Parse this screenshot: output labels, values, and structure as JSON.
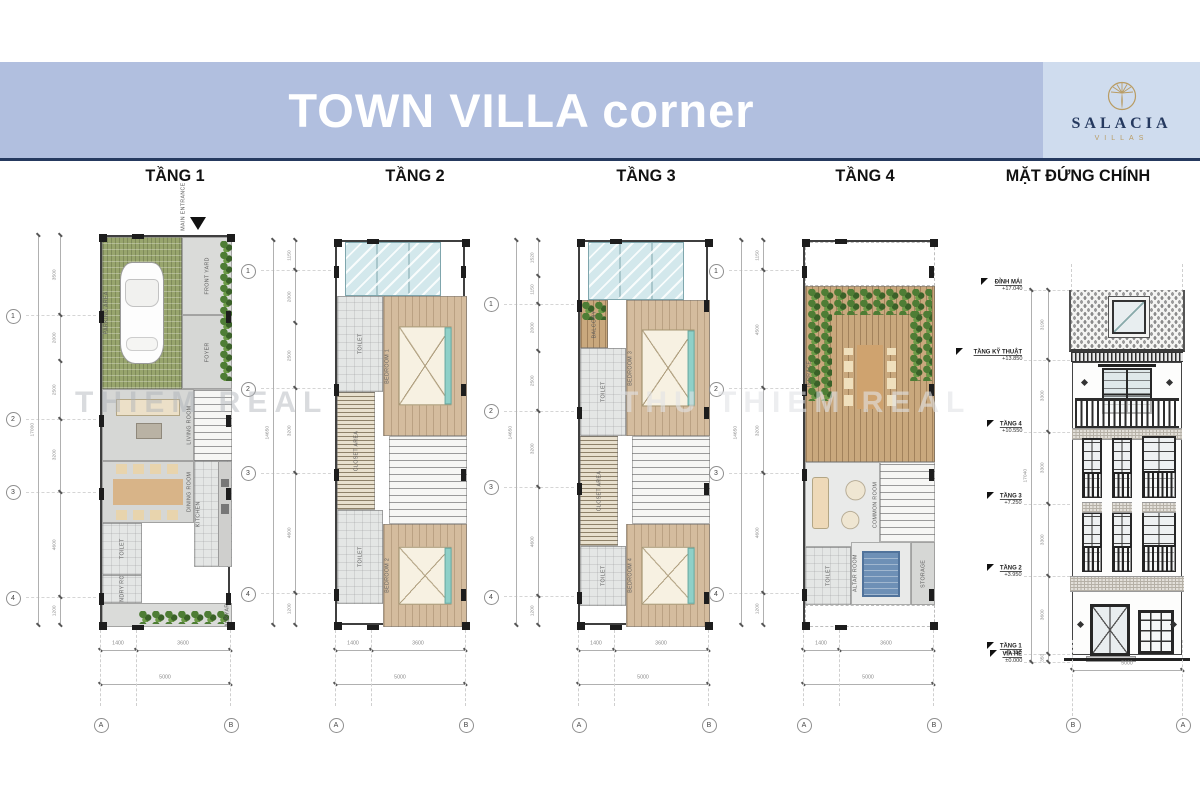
{
  "banner": {
    "title": "TOWN VILLA corner",
    "bg": "#b1bfdf",
    "logo_bg": "#cfdcee",
    "rule_color": "#25395f"
  },
  "logo": {
    "brand": "SALACIA",
    "subtitle": "VILLAS",
    "gold": "#b99c63",
    "navy": "#25395f"
  },
  "watermarks": [
    {
      "text": "THIEM REAL",
      "x": 75,
      "y": 386,
      "color": "rgba(170,175,182,0.45)"
    },
    {
      "text": "THU THIEM REAL",
      "x": 620,
      "y": 386,
      "color": "rgba(225,227,230,0.6)"
    }
  ],
  "plans": [
    {
      "header": "TẦNG 1",
      "hx": 175,
      "frame": {
        "x": 100,
        "y": 235,
        "w": 130,
        "h": 390
      },
      "entrance": "MAIN ENTRANCE",
      "dims": [
        "3500",
        "2000",
        "2500",
        "3200",
        "4600",
        "1200"
      ],
      "total": "17000",
      "grid_rows": [
        "1",
        "2",
        "3",
        "4"
      ],
      "grid_idx": [
        0,
        2,
        3,
        4
      ],
      "bottom_dims": [
        "1400",
        "3600"
      ],
      "bottom_total": "5000",
      "grid_cols": [
        "A",
        "B"
      ],
      "rooms": [
        {
          "label": "PARKING AREA",
          "x": 0,
          "y": 0,
          "w": 80,
          "h": 152,
          "cls": "grass",
          "dir": "v",
          "deco": "car",
          "lp": "l"
        },
        {
          "label": "",
          "x": 118,
          "y": 4,
          "w": 12,
          "h": 140,
          "cls": "none",
          "deco": "plantscol"
        },
        {
          "label": "FRONT YARD",
          "x": 80,
          "y": 0,
          "w": 50,
          "h": 78,
          "cls": "paving",
          "dir": "v"
        },
        {
          "label": "FOYER",
          "x": 80,
          "y": 78,
          "w": 50,
          "h": 74,
          "cls": "floorg",
          "dir": "v"
        },
        {
          "label": "LIVING ROOM",
          "x": 0,
          "y": 152,
          "w": 92,
          "h": 72,
          "cls": "floorg",
          "dir": "v",
          "deco": "sofa",
          "lp": "r"
        },
        {
          "label": "",
          "x": 92,
          "y": 152,
          "w": 38,
          "h": 72,
          "cls": "stair"
        },
        {
          "label": "DINING ROOM",
          "x": 0,
          "y": 224,
          "w": 92,
          "h": 62,
          "cls": "floorg",
          "dir": "v",
          "deco": "table8",
          "lp": "r"
        },
        {
          "label": "KITCHEN",
          "x": 92,
          "y": 224,
          "w": 38,
          "h": 106,
          "cls": "tile",
          "dir": "v",
          "deco": "counter",
          "lp": "l"
        },
        {
          "label": "TOILET",
          "x": 0,
          "y": 286,
          "w": 40,
          "h": 52,
          "cls": "tile",
          "dir": "v"
        },
        {
          "label": "LAUNDRY ROOM",
          "x": 0,
          "y": 338,
          "w": 40,
          "h": 28,
          "cls": "tile",
          "dir": "v"
        },
        {
          "label": "BACKYARD",
          "x": 0,
          "y": 366,
          "w": 130,
          "h": 24,
          "cls": "paving",
          "dir": "v",
          "deco": "plantsrow",
          "lp": "r"
        }
      ]
    },
    {
      "header": "TẦNG 2",
      "hx": 415,
      "frame": {
        "x": 335,
        "y": 240,
        "w": 130,
        "h": 385
      },
      "dims": [
        "1150",
        "2000",
        "2500",
        "3200",
        "4600",
        "1200"
      ],
      "total": "14650",
      "grid_rows": [
        "1",
        "2",
        "3",
        "4"
      ],
      "grid_idx": [
        0,
        2,
        3,
        4
      ],
      "bottom_dims": [
        "1400",
        "3600"
      ],
      "bottom_total": "5000",
      "grid_cols": [
        "A",
        "B"
      ],
      "rooms": [
        {
          "label": "",
          "x": 8,
          "y": 0,
          "w": 96,
          "h": 54,
          "cls": "glass"
        },
        {
          "label": "TOILET",
          "x": 0,
          "y": 54,
          "w": 46,
          "h": 96,
          "cls": "tile",
          "dir": "v"
        },
        {
          "label": "BEDROOM 1",
          "x": 46,
          "y": 54,
          "w": 84,
          "h": 140,
          "cls": "wood",
          "dir": "v",
          "deco": "bed",
          "lp": "l"
        },
        {
          "label": "CLOSET AREA",
          "x": 0,
          "y": 150,
          "w": 38,
          "h": 118,
          "cls": "hatchv",
          "dir": "v"
        },
        {
          "label": "",
          "x": 52,
          "y": 194,
          "w": 78,
          "h": 88,
          "cls": "stair"
        },
        {
          "label": "TOILET",
          "x": 0,
          "y": 268,
          "w": 46,
          "h": 94,
          "cls": "tile",
          "dir": "v"
        },
        {
          "label": "BEDROOM 2",
          "x": 46,
          "y": 282,
          "w": 84,
          "h": 103,
          "cls": "wood",
          "dir": "v",
          "deco": "bed",
          "lp": "l"
        }
      ]
    },
    {
      "header": "TẦNG 3",
      "hx": 646,
      "frame": {
        "x": 578,
        "y": 240,
        "w": 130,
        "h": 385
      },
      "dims": [
        "1520",
        "1150",
        "2000",
        "2500",
        "3200",
        "4600",
        "1200"
      ],
      "total": "14650",
      "grid_rows": [
        "1",
        "2",
        "3",
        "4"
      ],
      "grid_idx": [
        1,
        3,
        4,
        5
      ],
      "bottom_dims": [
        "1400",
        "3600"
      ],
      "bottom_total": "5000",
      "grid_cols": [
        "A",
        "B"
      ],
      "rooms": [
        {
          "label": "",
          "x": 8,
          "y": 0,
          "w": 96,
          "h": 58,
          "cls": "glass"
        },
        {
          "label": "BALCONY",
          "x": 0,
          "y": 58,
          "w": 28,
          "h": 48,
          "cls": "deck",
          "dir": "v",
          "deco": "plantsmini"
        },
        {
          "label": "TOILET",
          "x": 0,
          "y": 106,
          "w": 46,
          "h": 88,
          "cls": "tile",
          "dir": "v"
        },
        {
          "label": "BEDROOM 3",
          "x": 46,
          "y": 58,
          "w": 84,
          "h": 136,
          "cls": "wood",
          "dir": "v",
          "deco": "bed",
          "lp": "l"
        },
        {
          "label": "CLOSET AREA",
          "x": 0,
          "y": 194,
          "w": 38,
          "h": 110,
          "cls": "hatchv",
          "dir": "v"
        },
        {
          "label": "",
          "x": 52,
          "y": 194,
          "w": 78,
          "h": 88,
          "cls": "stair"
        },
        {
          "label": "TOILET",
          "x": 0,
          "y": 304,
          "w": 46,
          "h": 60,
          "cls": "tile",
          "dir": "v"
        },
        {
          "label": "BEDROOM 4",
          "x": 46,
          "y": 282,
          "w": 84,
          "h": 103,
          "cls": "wood",
          "dir": "v",
          "deco": "bed",
          "lp": "l"
        }
      ]
    },
    {
      "header": "TẦNG 4",
      "hx": 865,
      "frame": {
        "x": 803,
        "y": 240,
        "w": 130,
        "h": 385
      },
      "dims": [
        "1150",
        "4500",
        "3200",
        "4600",
        "1200"
      ],
      "total": "14650",
      "grid_rows": [
        "1",
        "2",
        "3",
        "4"
      ],
      "grid_idx": [
        0,
        1,
        2,
        3
      ],
      "bottom_dims": [
        "1400",
        "3600"
      ],
      "bottom_total": "5000",
      "grid_cols": [
        "A",
        "B"
      ],
      "rooms": [
        {
          "label": "",
          "x": 0,
          "y": 0,
          "w": 130,
          "h": 44,
          "cls": "open"
        },
        {
          "label": "TERRACE",
          "x": 0,
          "y": 44,
          "w": 130,
          "h": 176,
          "cls": "deck",
          "dir": "v",
          "deco": "terrace",
          "lp": "l"
        },
        {
          "label": "COMMON ROOM",
          "x": 0,
          "y": 220,
          "w": 75,
          "h": 85,
          "cls": "marble",
          "dir": "v",
          "deco": "sofa2",
          "lp": "r"
        },
        {
          "label": "",
          "x": 75,
          "y": 220,
          "w": 55,
          "h": 80,
          "cls": "stair"
        },
        {
          "label": "ALTAR ROOM",
          "x": 46,
          "y": 300,
          "w": 60,
          "h": 63,
          "cls": "marble",
          "dir": "v",
          "deco": "rug",
          "lp": "l"
        },
        {
          "label": "TOILET",
          "x": 0,
          "y": 305,
          "w": 46,
          "h": 58,
          "cls": "tile",
          "dir": "v"
        },
        {
          "label": "STORAGE",
          "x": 106,
          "y": 300,
          "w": 24,
          "h": 63,
          "cls": "floorg",
          "dir": "v"
        },
        {
          "label": "",
          "x": 0,
          "y": 363,
          "w": 130,
          "h": 22,
          "cls": "open"
        }
      ]
    }
  ],
  "elevation": {
    "header": "MẶT ĐỨNG CHÍNH",
    "hx": 1078,
    "levels": [
      {
        "label": "ĐỈNH MÁI",
        "value": "+17.040",
        "m": 17.04
      },
      {
        "label": "TẦNG KỸ THUẬT",
        "value": "+13.850",
        "m": 13.85
      },
      {
        "label": "TẦNG 4",
        "value": "+10.550",
        "m": 10.55
      },
      {
        "label": "TẦNG 3",
        "value": "+7.250",
        "m": 7.25
      },
      {
        "label": "TẦNG 2",
        "value": "+3.950",
        "m": 3.95
      },
      {
        "label": "TẦNG 1",
        "value": "+0.350",
        "m": 0.35
      },
      {
        "label": "VỈA HÈ",
        "value": "±0.000",
        "m": 0.0
      }
    ],
    "segments": [
      "3190",
      "3300",
      "3300",
      "3300",
      "3600",
      "350"
    ],
    "total": "17040",
    "bottom_total": "5000",
    "grid_cols": [
      "B",
      "A"
    ]
  }
}
